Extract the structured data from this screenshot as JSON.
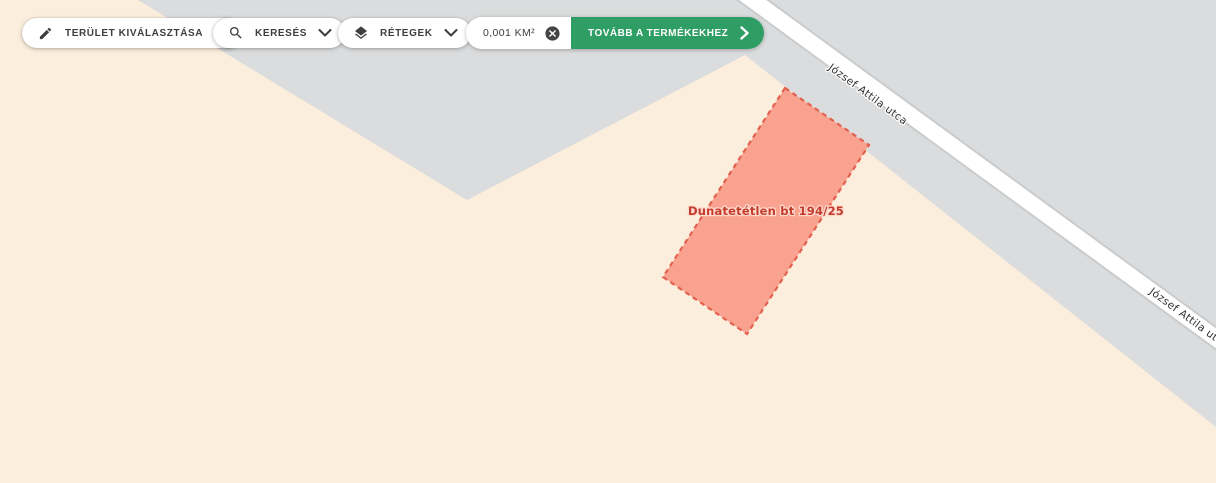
{
  "toolbar": {
    "area_select": {
      "label": "TERÜLET KIVÁLASZTÁSA"
    },
    "search": {
      "label": "KERESÉS"
    },
    "layers": {
      "label": "RÉTEGEK"
    },
    "area_chip": {
      "value": "0,001 KM²"
    },
    "proceed": {
      "label": "TOVÁBB A TERMÉKEKHEZ"
    }
  },
  "map": {
    "parcel_label": "Dunatetétlen bt 194/25",
    "road_name": "József Attila utca",
    "colors": {
      "land": "#fbeedd",
      "built_area": "#dbdcdd",
      "road": "#ffffff",
      "road_casing": "#c9cbcd",
      "parcel_fill": "#f9a28f",
      "parcel_border": "#e4604e",
      "parcel_text": "#c23b2c",
      "accent_green": "#2f9e64"
    }
  }
}
